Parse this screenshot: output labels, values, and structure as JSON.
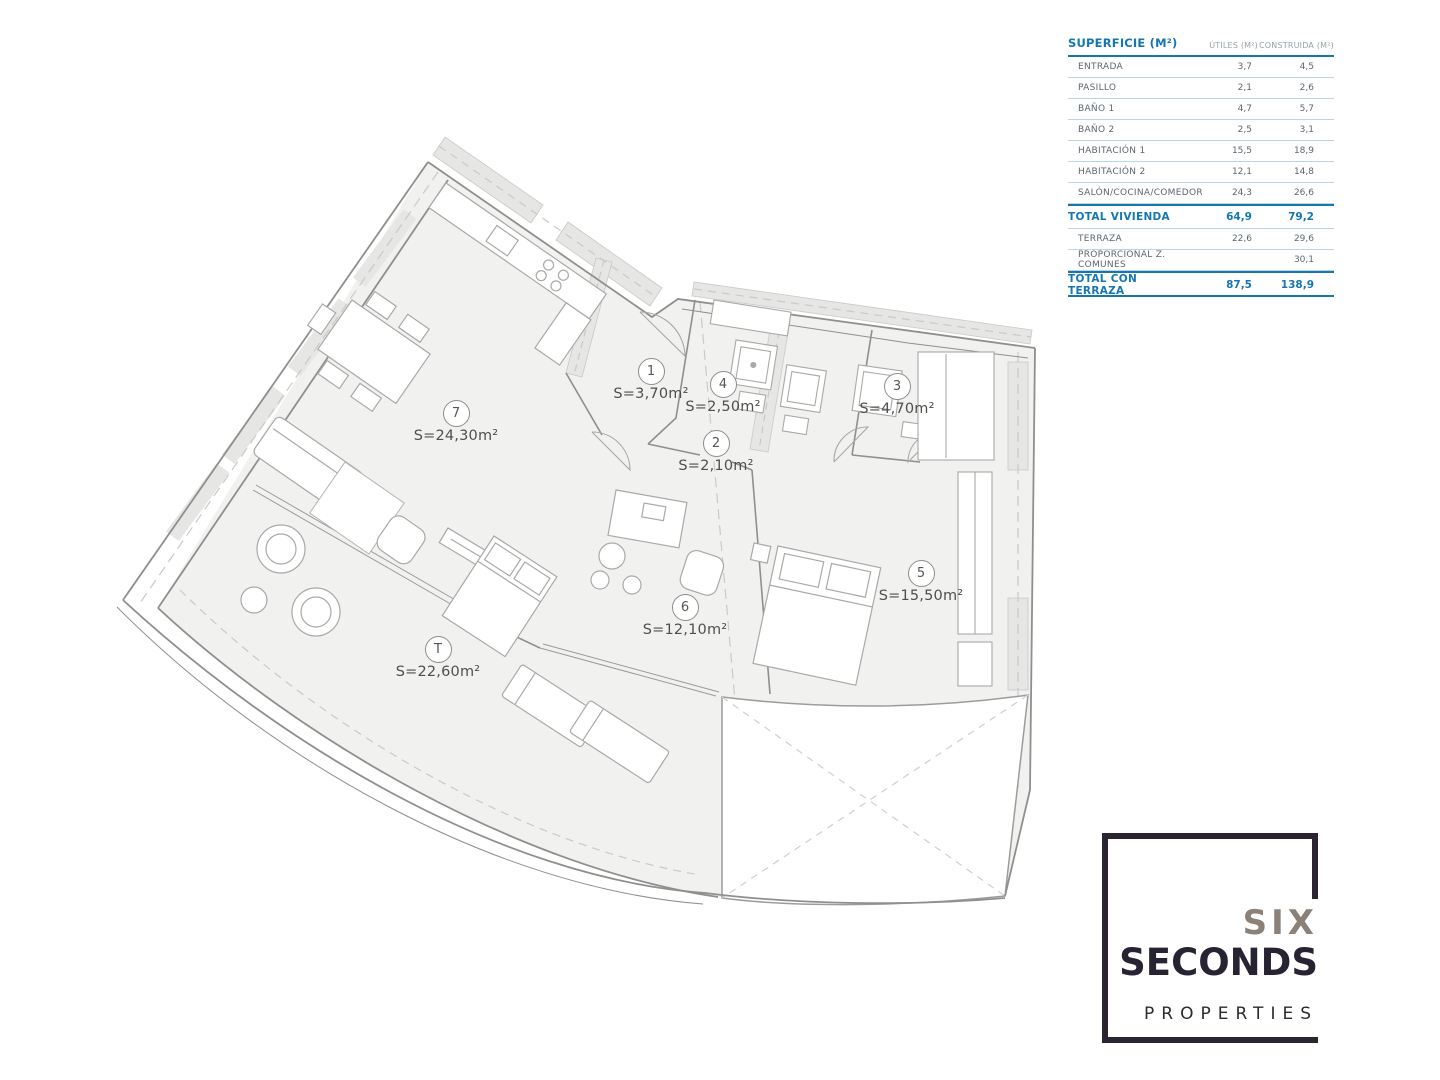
{
  "table": {
    "title": "SUPERFICIE (M²)",
    "col_utiles": "ÚTILES (M²)",
    "col_construida": "CONSTRUIDA (M²)",
    "rows": [
      {
        "label": "ENTRADA",
        "utiles": "3,7",
        "construida": "4,5"
      },
      {
        "label": "PASILLO",
        "utiles": "2,1",
        "construida": "2,6"
      },
      {
        "label": "BAÑO 1",
        "utiles": "4,7",
        "construida": "5,7"
      },
      {
        "label": "BAÑO 2",
        "utiles": "2,5",
        "construida": "3,1"
      },
      {
        "label": "HABITACIÓN 1",
        "utiles": "15,5",
        "construida": "18,9"
      },
      {
        "label": "HABITACIÓN 2",
        "utiles": "12,1",
        "construida": "14,8"
      },
      {
        "label": "SALÓN/COCINA/COMEDOR",
        "utiles": "24,3",
        "construida": "26,6"
      },
      {
        "label": "TOTAL VIVIENDA",
        "utiles": "64,9",
        "construida": "79,2"
      },
      {
        "label": "TERRAZA",
        "utiles": "22,6",
        "construida": "29,6"
      },
      {
        "label": "PROPORCIONAL Z. COMUNES",
        "utiles": "",
        "construida": "30,1"
      },
      {
        "label": "TOTAL CON TERRAZA",
        "utiles": "87,5",
        "construida": "138,9"
      }
    ]
  },
  "plan": {
    "rooms": [
      {
        "num": "7",
        "area": "S=24,30m²"
      },
      {
        "num": "1",
        "area": "S=3,70m²"
      },
      {
        "num": "4",
        "area": "S=2,50m²"
      },
      {
        "num": "3",
        "area": "S=4,70m²"
      },
      {
        "num": "2",
        "area": "S=2,10m²"
      },
      {
        "num": "5",
        "area": "S=15,50m²"
      },
      {
        "num": "6",
        "area": "S=12,10m²"
      },
      {
        "num": "T",
        "area": "S=22,60m²"
      }
    ]
  },
  "logo": {
    "line1": "SIX",
    "line2": "SECONDS",
    "line3": "PROPERTIES"
  },
  "colors": {
    "accent_blue": "#1577b2",
    "table_line": "#bdd5e3",
    "logo_dark": "#2a2530",
    "logo_gray": "#8b8179",
    "plan_fill": "#f1f1ef"
  }
}
